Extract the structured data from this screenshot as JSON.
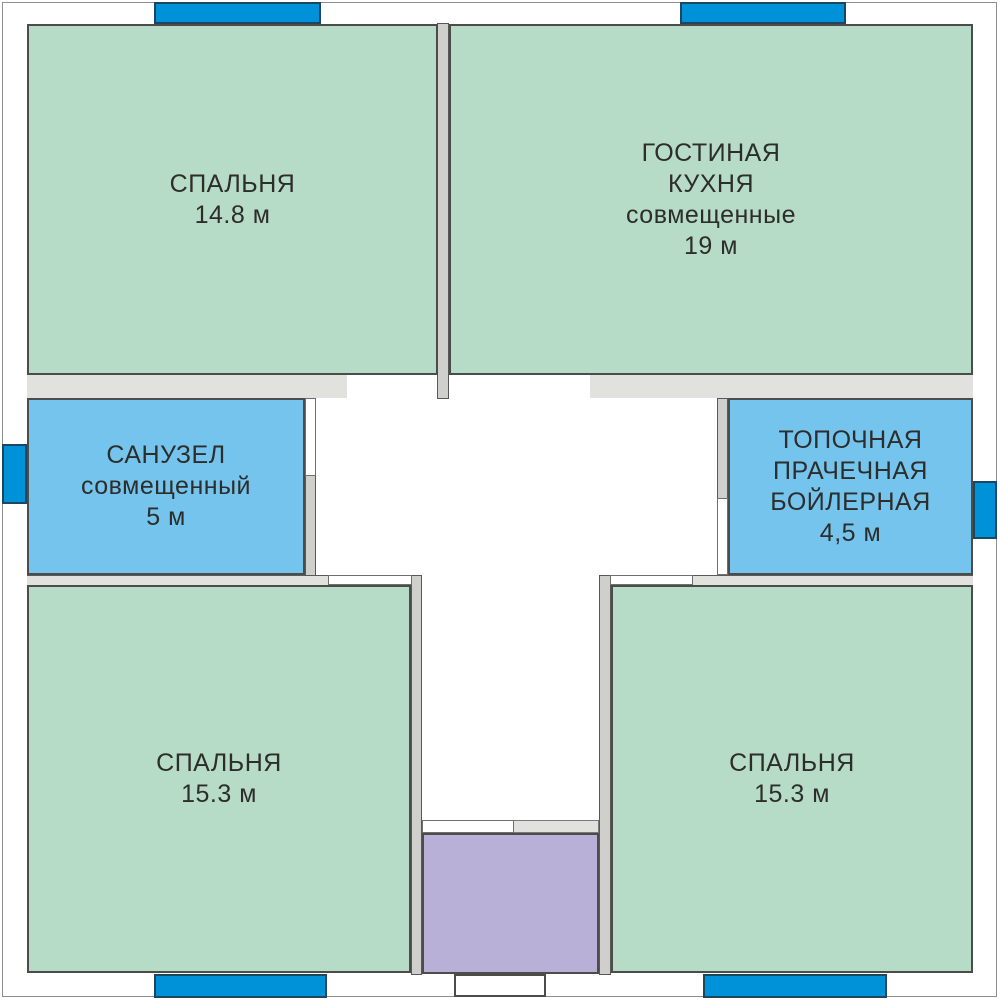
{
  "floor_plan": {
    "colors": {
      "room_green": "#b6dbc6",
      "room_blue": "#74c4ed",
      "room_purple": "#b8b0d7",
      "window_blue": "#0092d8",
      "window_outline": "#1e465f",
      "wall_strip": "#e1e1de",
      "wall_fill": "#cfcfcc",
      "outline_dark": "#4c4c4a",
      "door_outline": "#6f6f6d",
      "outer_line": "#8e8e8c",
      "text_color": "#2d2d2b"
    },
    "rooms": [
      {
        "name": "bedroom-top-left",
        "fill": "green",
        "label_lines": [
          "СПАЛЬНЯ",
          "14.8 м"
        ]
      },
      {
        "name": "living-kitchen",
        "fill": "green",
        "label_lines": [
          "ГОСТИНАЯ",
          "КУХНЯ",
          "совмещенные",
          "19 м"
        ]
      },
      {
        "name": "bathroom",
        "fill": "blue",
        "label_lines": [
          "САНУЗЕЛ",
          "совмещенный",
          "5 м"
        ]
      },
      {
        "name": "boiler-laundry",
        "fill": "blue",
        "label_lines": [
          "ТОПОЧНАЯ",
          "ПРАЧЕЧНАЯ",
          "БОЙЛЕРНАЯ",
          "4,5 м"
        ]
      },
      {
        "name": "bedroom-bottom-left",
        "fill": "green",
        "label_lines": [
          "СПАЛЬНЯ",
          "15.3 м"
        ]
      },
      {
        "name": "bedroom-bottom-right",
        "fill": "green",
        "label_lines": [
          "СПАЛЬНЯ",
          "15.3 м"
        ]
      },
      {
        "name": "utility-unlabeled",
        "fill": "purple",
        "label_lines": []
      }
    ]
  }
}
